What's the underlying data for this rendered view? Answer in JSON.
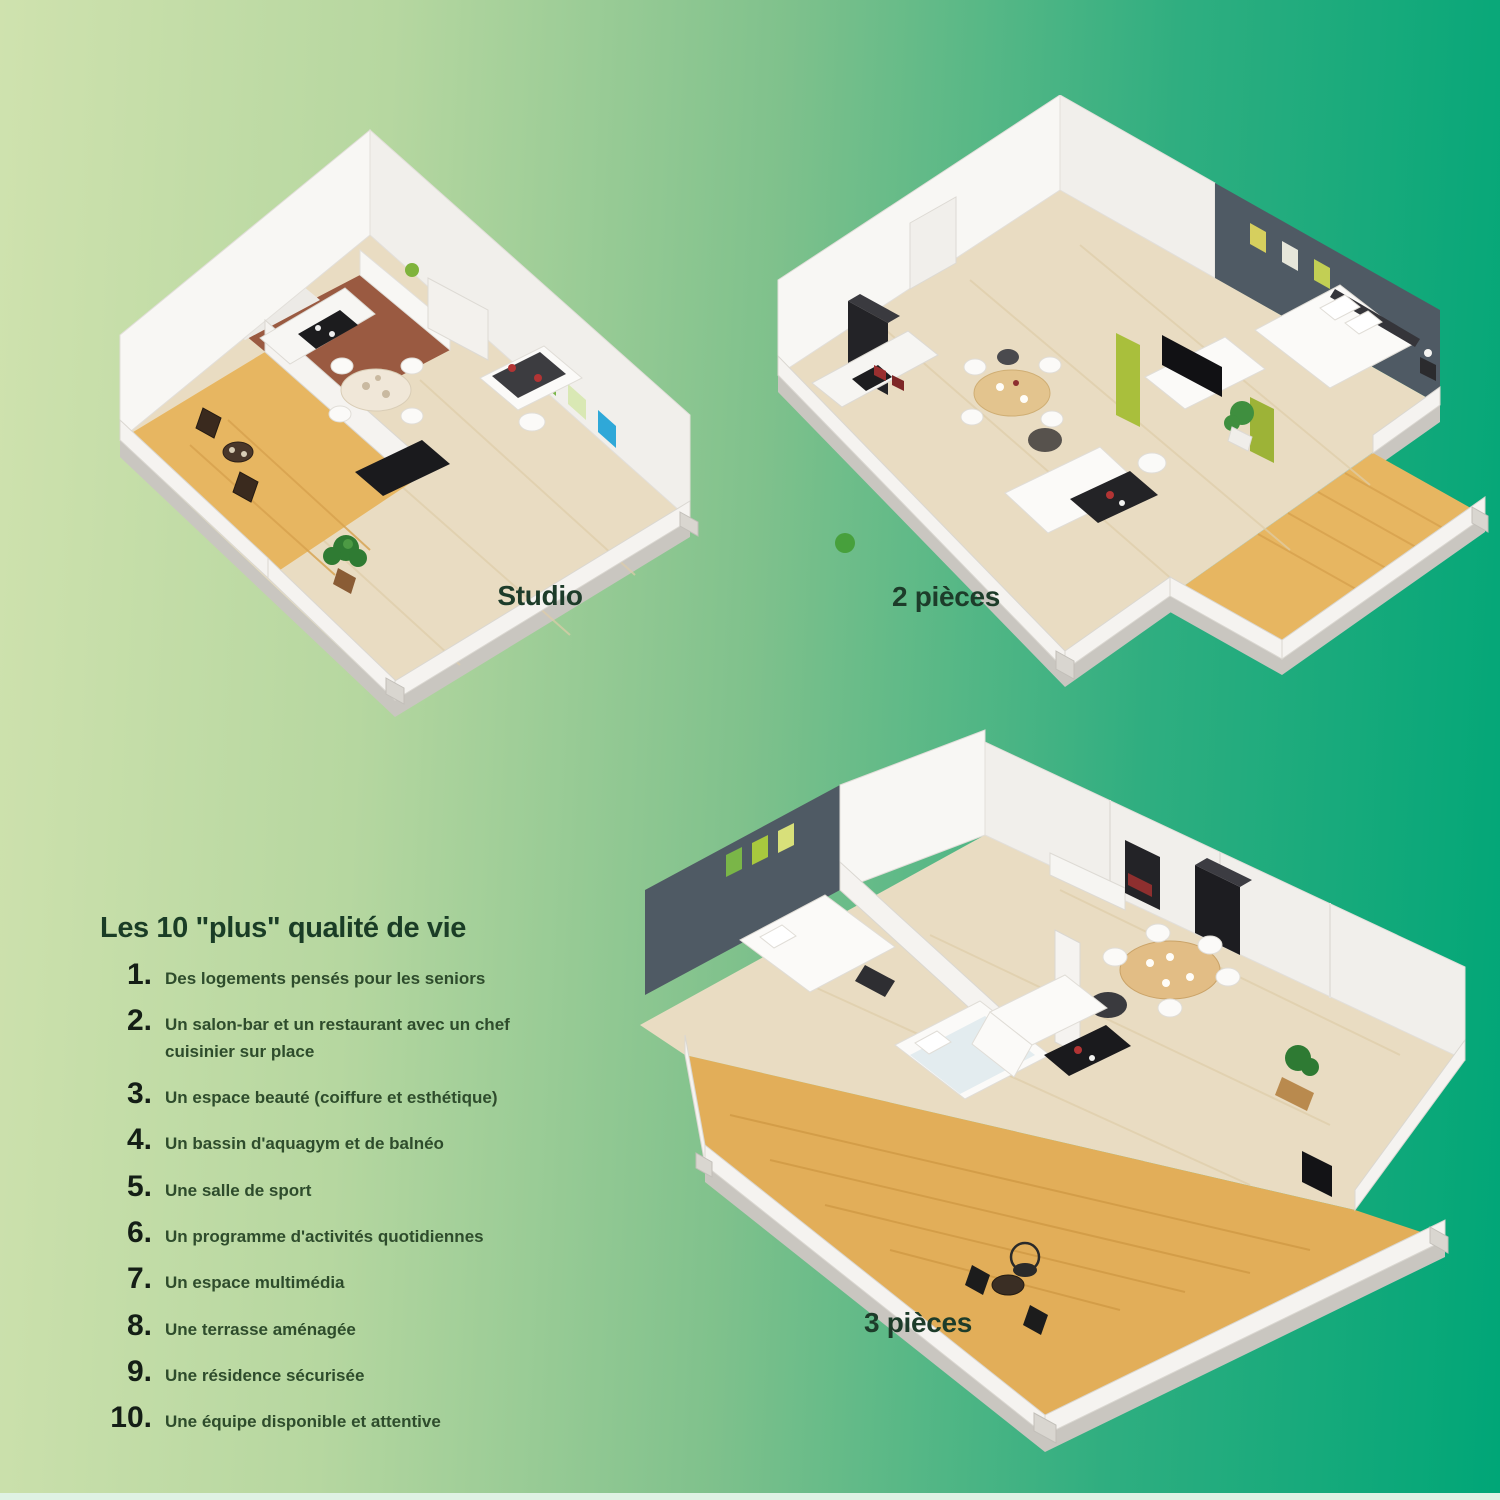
{
  "background": {
    "gradient_left": "#cfe2ae",
    "gradient_right": "#00a677",
    "bottom_strip": "#dff2e4"
  },
  "plans": {
    "studio": {
      "label": "Studio"
    },
    "two_rooms": {
      "label": "2 pièces"
    },
    "three_rooms": {
      "label": "3 pièces"
    }
  },
  "features": {
    "title": "Les 10 \"plus\" qualité de vie",
    "items": [
      {
        "num": "1.",
        "text": "Des logements pensés pour les seniors"
      },
      {
        "num": "2.",
        "text": "Un salon-bar et un restaurant avec un chef cuisinier sur place"
      },
      {
        "num": "3.",
        "text": "Un espace beauté (coiffure et esthétique)"
      },
      {
        "num": "4.",
        "text": "Un bassin d'aquagym et de balnéo"
      },
      {
        "num": "5.",
        "text": "Une salle de sport"
      },
      {
        "num": "6.",
        "text": "Un programme d'activités quotidiennes"
      },
      {
        "num": "7.",
        "text": "Un espace multimédia"
      },
      {
        "num": "8.",
        "text": "Une terrasse aménagée"
      },
      {
        "num": "9.",
        "text": "Une résidence sécurisée"
      },
      {
        "num": "10.",
        "text": "Une équipe disponible et attentive"
      }
    ]
  },
  "colors": {
    "text_title": "#1a3d26",
    "text_item": "#2e4c2c",
    "text_number": "#141e16",
    "plan_label": "#1d3c2a",
    "accent_wall": "#4f5a64",
    "terrace_deck": "#e7b661",
    "wood_floor": "#e9dcc2",
    "frame_green": "#7ab648",
    "frame_blue": "#2fa8d8"
  }
}
